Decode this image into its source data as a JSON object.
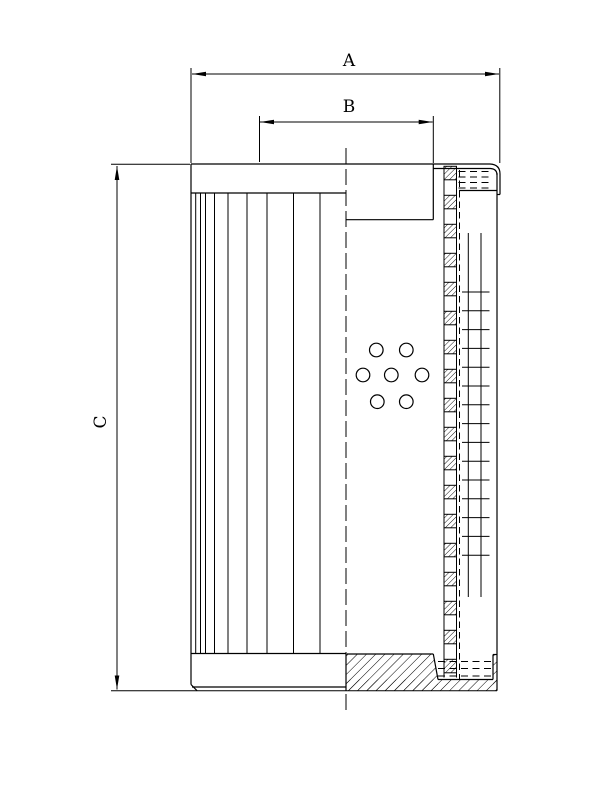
{
  "title": "Filter element sectional drawing",
  "colors": {
    "line": "#000000",
    "background": "#ffffff"
  },
  "dimensions": {
    "A": {
      "label": "A",
      "description": "outer diameter across top end cap"
    },
    "B": {
      "label": "B",
      "description": "inner collar bore diameter"
    },
    "C": {
      "label": "C",
      "description": "overall element height"
    }
  },
  "drawing": {
    "pleats": {
      "x_positions": [
        195.7,
        200.5,
        205.5,
        214.5,
        228,
        247,
        267,
        293.5,
        320
      ],
      "y_top": 193,
      "y_bottom": 653.5
    },
    "perforation_holes": {
      "radius": 6.8,
      "centers": [
        [
          376.3,
          350
        ],
        [
          406.3,
          350
        ],
        [
          363,
          375
        ],
        [
          391.3,
          375
        ],
        [
          422,
          375
        ],
        [
          377.3,
          401.7
        ],
        [
          406.3,
          401.7
        ]
      ]
    },
    "core_tube": {
      "x": 444,
      "width": 12.5,
      "first_y": 166.3,
      "square_height": 13.5,
      "period": 29,
      "count": 18,
      "border_top": 166,
      "border_bottom": 677.5
    },
    "mesh": {
      "vertical_x": [
        468.3,
        481
      ],
      "vertical_y_top": 233,
      "vertical_y_bottom": 597,
      "rung_x1": 462,
      "rung_x2": 489.5,
      "rung_first_y": 292,
      "rung_step": 18.8,
      "rung_count": 15
    },
    "glue_top": {
      "rows_y": [
        171.5,
        177,
        182.5,
        188
      ],
      "x1": 458.5,
      "x2": 492.5
    },
    "glue_bottom": {
      "rows_y": [
        661.5,
        668.5,
        676
      ],
      "x1": 438,
      "x2": 493
    }
  }
}
